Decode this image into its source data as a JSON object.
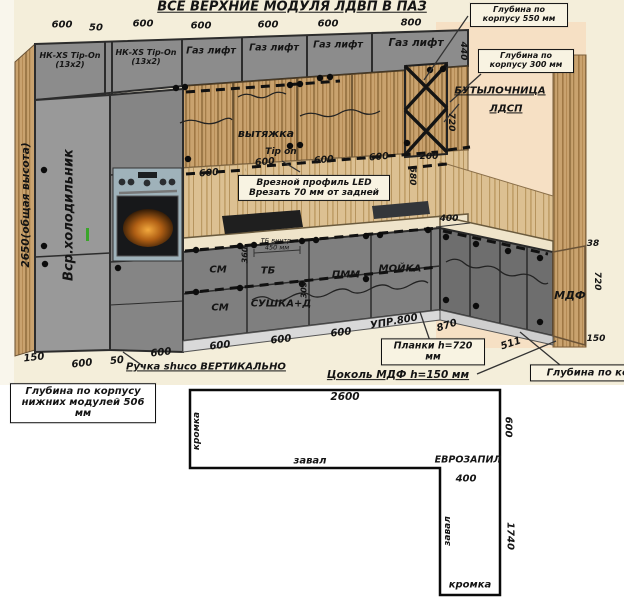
{
  "title": "ВСЕ ВЕРХНИЕ МОДУЛЯ ЛДВП В ПАЗ",
  "colors": {
    "paper_cream": "#f4eeda",
    "wall_pink": "#f6e0c4",
    "wood": "#c9a26e",
    "wood_light": "#dcc092",
    "cabinet_gray": "#8c8c8c",
    "outline": "#2c2c2c",
    "callout_bg": "#f8f3e2",
    "text": "#141414"
  },
  "labels": [
    {
      "name": "page-title",
      "text": "ВСЕ ВЕРХНИЕ МОДУЛЯ ЛДВП В ПАЗ",
      "x": 292,
      "y": 8,
      "fs": 13,
      "ul": true
    },
    {
      "name": "dim-top-600-1",
      "text": "600",
      "x": 62,
      "y": 25,
      "fs": 10
    },
    {
      "name": "dim-top-50",
      "text": "50",
      "x": 96,
      "y": 28,
      "fs": 10
    },
    {
      "name": "dim-top-600-2",
      "text": "600",
      "x": 143,
      "y": 24,
      "fs": 10
    },
    {
      "name": "dim-top-600-3",
      "text": "600",
      "x": 201,
      "y": 26,
      "fs": 10
    },
    {
      "name": "dim-top-600-4",
      "text": "600",
      "x": 268,
      "y": 25,
      "fs": 10
    },
    {
      "name": "dim-top-600-5",
      "text": "600",
      "x": 328,
      "y": 24,
      "fs": 10
    },
    {
      "name": "dim-top-800",
      "text": "800",
      "x": 411,
      "y": 23,
      "fs": 10
    },
    {
      "name": "upper-door-label-1",
      "text": "НК-XS Tip-On\n(13x2)",
      "x": 70,
      "y": 61,
      "fs": 8,
      "w": 66
    },
    {
      "name": "upper-door-label-2",
      "text": "НК-XS Tip-On\n(13x2)",
      "x": 146,
      "y": 58,
      "fs": 8,
      "w": 66
    },
    {
      "name": "upper-door-label-3",
      "text": "Газ лифт",
      "x": 211,
      "y": 52,
      "fs": 9.5
    },
    {
      "name": "upper-door-label-4",
      "text": "Газ лифт",
      "x": 274,
      "y": 49,
      "fs": 9.5
    },
    {
      "name": "upper-door-label-5",
      "text": "Газ лифт",
      "x": 338,
      "y": 46,
      "fs": 9.5
    },
    {
      "name": "upper-door-label-6",
      "text": "Газ лифт",
      "x": 416,
      "y": 44,
      "fs": 10.5
    },
    {
      "name": "callout-depth-550",
      "text": "Глубина по\nкорпусу 550 мм",
      "x": 519,
      "y": 15,
      "fs": 8,
      "w": 86,
      "box": true
    },
    {
      "name": "dim-440",
      "text": "440",
      "x": 463,
      "y": 51,
      "fs": 9,
      "rot": 90
    },
    {
      "name": "callout-depth-300",
      "text": "Глубина по\nкорпусу 300 мм",
      "x": 526,
      "y": 61,
      "fs": 8,
      "w": 84,
      "box": true
    },
    {
      "name": "label-bottle-rack",
      "text": "БУТЫЛОЧНИЦА",
      "x": 500,
      "y": 91,
      "fs": 10,
      "ul": true
    },
    {
      "name": "label-bottle-rack-material",
      "text": "ЛДСП",
      "x": 506,
      "y": 109,
      "fs": 10,
      "ul": true
    },
    {
      "name": "dim-720-rack",
      "text": "720",
      "x": 451,
      "y": 122,
      "fs": 9,
      "rot": 90
    },
    {
      "name": "dim-200",
      "text": "200",
      "x": 429,
      "y": 157,
      "fs": 9
    },
    {
      "name": "dim-total-height",
      "text": "2650(общая высота)",
      "x": 27,
      "y": 205,
      "fs": 10.5,
      "rot": -90
    },
    {
      "name": "label-fridge",
      "text": "Вср.холодильник",
      "x": 70,
      "y": 215,
      "fs": 13,
      "rot": -90
    },
    {
      "name": "label-hood",
      "text": "вытяжка",
      "x": 266,
      "y": 134,
      "fs": 11
    },
    {
      "name": "label-tip-on",
      "text": "Tip on",
      "x": 281,
      "y": 152,
      "fs": 9
    },
    {
      "name": "dim-mid-600-1",
      "text": "600",
      "x": 209,
      "y": 174,
      "fs": 9.5,
      "rot": -5
    },
    {
      "name": "dim-mid-600-2",
      "text": "600",
      "x": 265,
      "y": 163,
      "fs": 9.5,
      "rot": -5
    },
    {
      "name": "dim-mid-600-3",
      "text": "600",
      "x": 324,
      "y": 161,
      "fs": 9.5,
      "rot": -5
    },
    {
      "name": "dim-mid-600-4",
      "text": "600",
      "x": 379,
      "y": 158,
      "fs": 9.5,
      "rot": -5
    },
    {
      "name": "dim-580",
      "text": "580",
      "x": 412,
      "y": 176,
      "fs": 9,
      "rot": 90
    },
    {
      "name": "callout-led",
      "text": "Врезной профиль LED\nВрезать 70 мм от задней",
      "x": 314,
      "y": 188,
      "fs": 9,
      "w": 140,
      "box": true
    },
    {
      "name": "label-module-sm-1",
      "text": "СМ",
      "x": 218,
      "y": 270,
      "fs": 10
    },
    {
      "name": "label-module-tb",
      "text": "ТБ",
      "x": 268,
      "y": 271,
      "fs": 10
    },
    {
      "name": "label-module-pmm",
      "text": "ПММ",
      "x": 346,
      "y": 275,
      "fs": 10
    },
    {
      "name": "label-module-sink",
      "text": "МОЙКА",
      "x": 400,
      "y": 269,
      "fs": 10
    },
    {
      "name": "label-module-sm-2",
      "text": "СМ",
      "x": 220,
      "y": 308,
      "fs": 10
    },
    {
      "name": "label-module-dryer",
      "text": "СУШКА+Д",
      "x": 281,
      "y": 304,
      "fs": 10
    },
    {
      "name": "label-module-upr800",
      "text": "УПР.800",
      "x": 394,
      "y": 322,
      "fs": 10,
      "rot": -10
    },
    {
      "name": "note-tb-inner",
      "text": "ТБ внутр.\n450 мм",
      "x": 277,
      "y": 245,
      "fs": 6.5,
      "w": 54,
      "bold": false
    },
    {
      "name": "dim-360-1",
      "text": "360",
      "x": 246,
      "y": 255,
      "fs": 8,
      "rot": -90
    },
    {
      "name": "dim-360-2",
      "text": "305",
      "x": 305,
      "y": 290,
      "fs": 8,
      "rot": -90
    },
    {
      "name": "dim-400-corner",
      "text": "400",
      "x": 449,
      "y": 219,
      "fs": 9
    },
    {
      "name": "dim-38",
      "text": "38",
      "x": 593,
      "y": 244,
      "fs": 9
    },
    {
      "name": "dim-720-right",
      "text": "720",
      "x": 597,
      "y": 281,
      "fs": 9,
      "rot": 90
    },
    {
      "name": "label-mdf-panel",
      "text": "МДФ",
      "x": 570,
      "y": 296,
      "fs": 11
    },
    {
      "name": "dim-150-right",
      "text": "150",
      "x": 596,
      "y": 339,
      "fs": 9
    },
    {
      "name": "dim-bot-150",
      "text": "150",
      "x": 34,
      "y": 358,
      "fs": 10,
      "rot": -6
    },
    {
      "name": "dim-bot-600-1",
      "text": "600",
      "x": 82,
      "y": 364,
      "fs": 10,
      "rot": -6
    },
    {
      "name": "dim-bot-50",
      "text": "50",
      "x": 117,
      "y": 361,
      "fs": 10,
      "rot": -6
    },
    {
      "name": "dim-bot-600-2",
      "text": "600",
      "x": 161,
      "y": 353,
      "fs": 10,
      "rot": -6
    },
    {
      "name": "dim-bot-600-3",
      "text": "600",
      "x": 220,
      "y": 346,
      "fs": 10,
      "rot": -6
    },
    {
      "name": "dim-bot-600-4",
      "text": "600",
      "x": 281,
      "y": 340,
      "fs": 10,
      "rot": -6
    },
    {
      "name": "dim-bot-600-5",
      "text": "600",
      "x": 341,
      "y": 333,
      "fs": 10,
      "rot": -6
    },
    {
      "name": "dim-870-1",
      "text": "870",
      "x": 447,
      "y": 326,
      "fs": 10,
      "rot": -18
    },
    {
      "name": "dim-870-2",
      "text": "511",
      "x": 511,
      "y": 344,
      "fs": 10,
      "rot": -18
    },
    {
      "name": "note-handle",
      "text": "Ручка shuco ВЕРТИКАЛЬНО",
      "x": 206,
      "y": 367,
      "fs": 10,
      "ul": true
    },
    {
      "name": "callout-planki",
      "text": "Планки h=720 мм",
      "x": 433,
      "y": 352,
      "fs": 9.5,
      "w": 92,
      "box": true
    },
    {
      "name": "note-plinth",
      "text": "Цоколь МДФ h=150 мм",
      "x": 398,
      "y": 376,
      "fs": 10.5,
      "ul": true
    },
    {
      "name": "callout-depth-base",
      "text": "Глубина по корпусу\nнижних модулей 506 мм",
      "x": 83,
      "y": 403,
      "fs": 10,
      "w": 134,
      "box": true,
      "bg": "#ffffff"
    },
    {
      "name": "callout-depth-cut",
      "text": "Глубина по корпу",
      "x": 598,
      "y": 373,
      "fs": 10,
      "w": 124,
      "box": true
    },
    {
      "name": "plan-dim-2600",
      "text": "2600",
      "x": 345,
      "y": 398,
      "fs": 10.5
    },
    {
      "name": "plan-edge-label-1",
      "text": "кромка",
      "x": 197,
      "y": 431,
      "fs": 9,
      "rot": -90
    },
    {
      "name": "plan-dim-600",
      "text": "600",
      "x": 508,
      "y": 427,
      "fs": 10,
      "rot": 90
    },
    {
      "name": "plan-zaval-1",
      "text": "завал",
      "x": 310,
      "y": 461,
      "fs": 10
    },
    {
      "name": "plan-eurocut",
      "text": "ЕВРОЗАПИЛ",
      "x": 468,
      "y": 461,
      "fs": 9.5
    },
    {
      "name": "plan-dim-400",
      "text": "400",
      "x": 466,
      "y": 479,
      "fs": 10
    },
    {
      "name": "plan-zaval-2",
      "text": "завал",
      "x": 448,
      "y": 531,
      "fs": 9,
      "rot": -90
    },
    {
      "name": "plan-dim-1740",
      "text": "1740",
      "x": 510,
      "y": 536,
      "fs": 10,
      "rot": 90
    },
    {
      "name": "plan-edge-label-2",
      "text": "кромка",
      "x": 470,
      "y": 585,
      "fs": 10
    }
  ]
}
